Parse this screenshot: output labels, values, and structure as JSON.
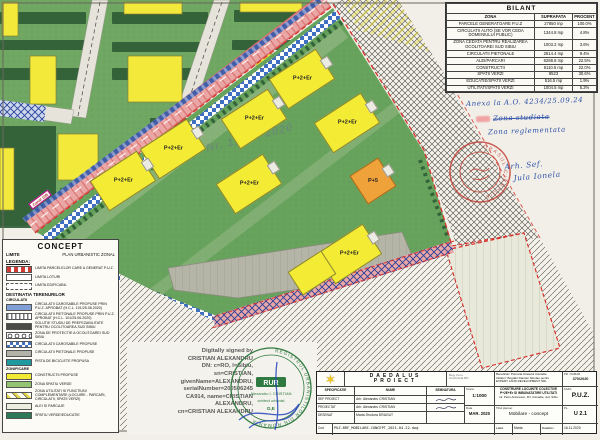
{
  "bilant": {
    "title": "BILANT",
    "headers": {
      "zona": "ZONA",
      "suprafata": "SUPRAFATA",
      "procent": "PROCENT"
    },
    "rows": [
      {
        "z": "PARCELE GENERATOARE P.U.Z",
        "s": "27850 mp",
        "p": "100.0%"
      },
      {
        "z": "CIRCULATII AUTO (SE VOR CEDA DOMENIULUI PUBLIC)",
        "s": "1344.8 mp",
        "p": "4.8%"
      },
      {
        "z": "ZONA CEDATA PENTRU REALIZAREA OCOLITOAREI SUD SIBIU",
        "s": "1003.2 mp",
        "p": "3.6%"
      },
      {
        "z": "CIRCULATII PIETONALE",
        "s": "2614.4 mp",
        "p": "9.4%"
      },
      {
        "z": "ALEI/PARCARI",
        "s": "6288.8 mp",
        "p": "22.5%"
      },
      {
        "z": "CONSTRUCTII",
        "s": "6110.5 mp",
        "p": "22.0%"
      },
      {
        "z": "SPATII VERZI",
        "s": "8523",
        "p": "30.6%"
      },
      {
        "z": "EDUCATIE/SPATII VERZI",
        "s": "516.5 mp",
        "p": "1.9%"
      },
      {
        "z": "UTILITATI/SPATII VERZI",
        "s": "1004.5 mp",
        "p": "5.2%"
      }
    ]
  },
  "notes": {
    "anexa": "Anexa la A.O. 4234/25.09.24",
    "zona_studiata": "Zona studiata",
    "zona_reglementata": "Zona reglementata",
    "arh_sef": "Arh. Sef.",
    "arh_sef_name": "Jula Ionela"
  },
  "map": {
    "street_label": "Canal 10B",
    "watermark": "Nr. 1119 / 2020",
    "buildings": [
      "P+2+Er",
      "P+2+Er",
      "P+2+Er",
      "P+2+Er",
      "P+2+Er",
      "P+2+Er",
      "P+5",
      "P+2+Er"
    ],
    "red_stamp_ring": "ORASUL CISNADIE"
  },
  "concept": {
    "title": "CONCEPT",
    "limite": "LIMITE",
    "plan": "PLAN URBANISTIC ZONAL",
    "legenda": "LEGENDA:",
    "destinatia": "DESTINATIA TERENURILOR",
    "circulatii": "CIRCULATII",
    "zonificare": "ZONIFICARE",
    "items": [
      "LIMITA PARCELELOR CARE A GENERAT P.U.Z.",
      "LIMITA LOTURI",
      "LIMITA EDIFICABIL",
      "CIRCULATII CAROSABILE PROPUSE PRIN P.U.Z. APROBAT (H.C.L. 101/25.06.2020)",
      "CIRCULATII PIETONALE PROPUSE PRIN P.U.Z. APROBAT (H.C.L. 101/25.06.2020)",
      "SOLUTIE STUDIU DE PREFEZABILITATE PENTRU OCOLITOAREA SUD SIBIU",
      "ZONA DE PROTECTIE A OCOLITOAREI SUD SIBIU",
      "CIRCULATII CAROSABILE PROPUSE",
      "CIRCULATII PIETONALE PROPUSE",
      "PISTA DE BICICLETE PROPUSA",
      "CONSTRUCTII PROPUSE",
      "ZONA SPATIU VERDE",
      "ZONA UTILITATI SI FUNCTIUNI COMPLEMENTARE (LOCUIRE - PARCARI, CIRCULATII, SPATII VERZI)",
      "ALEI SI PARCAJE",
      "SPATIU VERDE/EDUCATIE"
    ]
  },
  "signature": {
    "lines": [
      "Digitally signed by",
      "CRISTIAN ALEXANDRU",
      "DN: c=RO, l=Sibiu,",
      "sn=CRISTIAN,",
      "givenName=ALEXANDRU,",
      "serialNumber=200506245",
      "CA914, name=CRISTIAN",
      "ALEXANDRU,",
      "cn=CRISTIAN ALEXANDRU"
    ]
  },
  "rur": {
    "ring": "REGISTRUL URBANISTILOR DIN ROMANIA",
    "acronym": "RUR",
    "name": "Alexandru I. CRISTIAN",
    "role": "arhitect urbanist",
    "categories": "D,E"
  },
  "titleblock": {
    "logo_glyph": "✶",
    "company1": "DAEDALUS",
    "company2": "PROIECT",
    "reg1": "Reg. Com.",
    "reg2": "Cod Fiscal RO",
    "spec": "SPECIFICATIE",
    "nume": "NUME",
    "semnatura": "SEMNATURA",
    "scara_label": "Scara:",
    "scara_value": "1:1000",
    "data_label": "Data",
    "data_value": "MAR. 2020",
    "sef_label": "SEF PROIECT",
    "sef_name": "Arh. Alexandru CRISTIAN",
    "proiectat_label": "PROIECTAT",
    "proiectat_name": "Arh. Alexandru CRISTIAN",
    "desenat_label": "DESENAT",
    "desenat_name": "Maria-Teodora DRAGUT",
    "beneficiar": "Beneficiar: Primaria Orasului Cisnadie",
    "initiator": "Initiator: Bogdan Damian Nicolae pentru EXPERT LAND DEVELOPMENT SRL",
    "pr_label": "PR. NUMAR",
    "pr_value": "370/2020",
    "proiect1": "CONSTRUIRE LOCUINTE COLECTIVE P+2E+Er SI IMBUNATATIRE UTILITATI",
    "proiect2": "str. Petru Antonescu, FN, Cisnadie, Jud. Sibiu",
    "faza_label": "FAZA:",
    "faza_value": "P.U.Z.",
    "titlu_label": "Titlul plansei:",
    "titlu_value": "Mobilare - concept",
    "pl_label": "PL.",
    "pl_value": "U 2.1",
    "cod_label": "Cod",
    "cod_value": "PUZ-BRF_MOBILARE-CONCEPT_2021.04.22.dwg",
    "laed_label": "LaEd.",
    "laed_value": "Maria",
    "rev_label": "DataRev",
    "rev_value": "16.11.2020"
  }
}
